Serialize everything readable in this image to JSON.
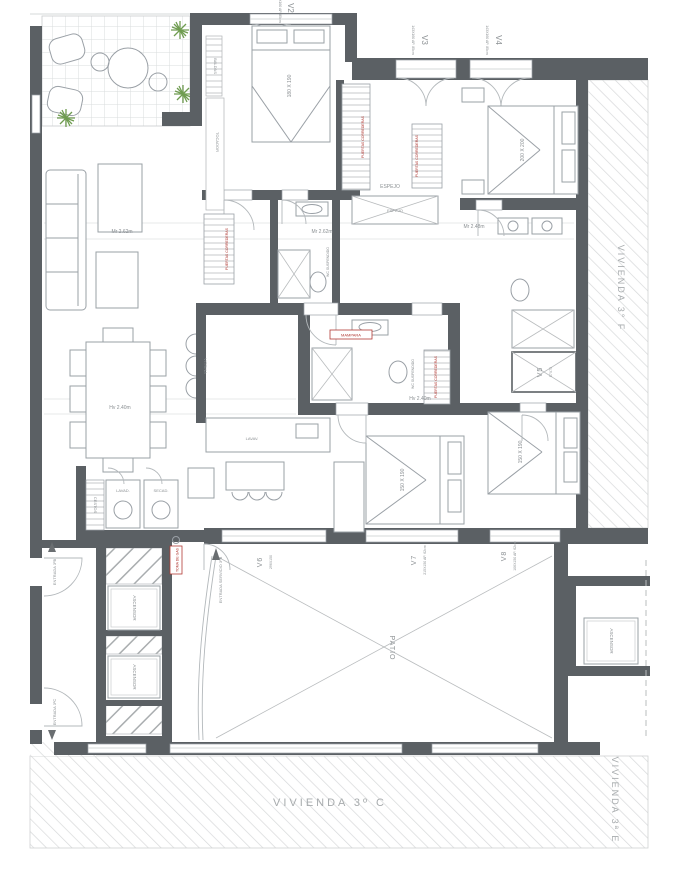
{
  "plan": {
    "colors": {
      "wall": "#5b6064",
      "annotation_red": "#b23b35",
      "plant_green": "#6f9c50"
    },
    "neighbors": {
      "right_top": "VIVIENDA 3° F",
      "bottom": "VIVIENDA 3º C",
      "right_bottom": "VIVIENDA 3ª E"
    },
    "rooms": {
      "patio": "PATIO"
    },
    "elevator": "ASCENSOR",
    "entrances": {
      "b": "ENTRADA 3ºB",
      "c": "ENTRADA 3ºC",
      "service": "ENTRADA SERVICIO 3ºB"
    },
    "windows": {
      "v2": {
        "id": "V2",
        "dims": "143X160 AP. 85cm"
      },
      "v3": {
        "id": "V3",
        "dims": "143X160 AP. 85cm"
      },
      "v4": {
        "id": "V4",
        "dims": "143X160 AP. 85cm"
      },
      "v5": {
        "id": "V5",
        "dims": "57X75"
      },
      "v6": {
        "id": "V6",
        "dims": "296X150"
      },
      "v7": {
        "id": "V7",
        "dims": "215X150 AP. 62cm"
      },
      "v8": {
        "id": "V8",
        "dims": "106X150 AP. 62cm"
      }
    },
    "beds": {
      "dorm1": "180 X 190",
      "principal": "200 X 200",
      "small": "150 X 190"
    },
    "heights": {
      "mr262": "Mr 2.62m",
      "mr248": "Mr 2.48m",
      "hv240": "Hv 2.40m"
    },
    "fixtures": {
      "tocador": "TOCADOR",
      "baldas": "BALDAS",
      "espejo": "ESPEJO",
      "vitrina": "VITRINA",
      "lavav": "LAVAV.",
      "lavad": "LAVAD.",
      "secad": "SECAD.",
      "cestos": "CESTOS",
      "wc": "WC SUSPENDIDO"
    },
    "red_notes": {
      "armario": "PUERTAS CORREDERAS",
      "mampara": "MAMPARA",
      "gas": "TOMA DE GAS"
    }
  }
}
